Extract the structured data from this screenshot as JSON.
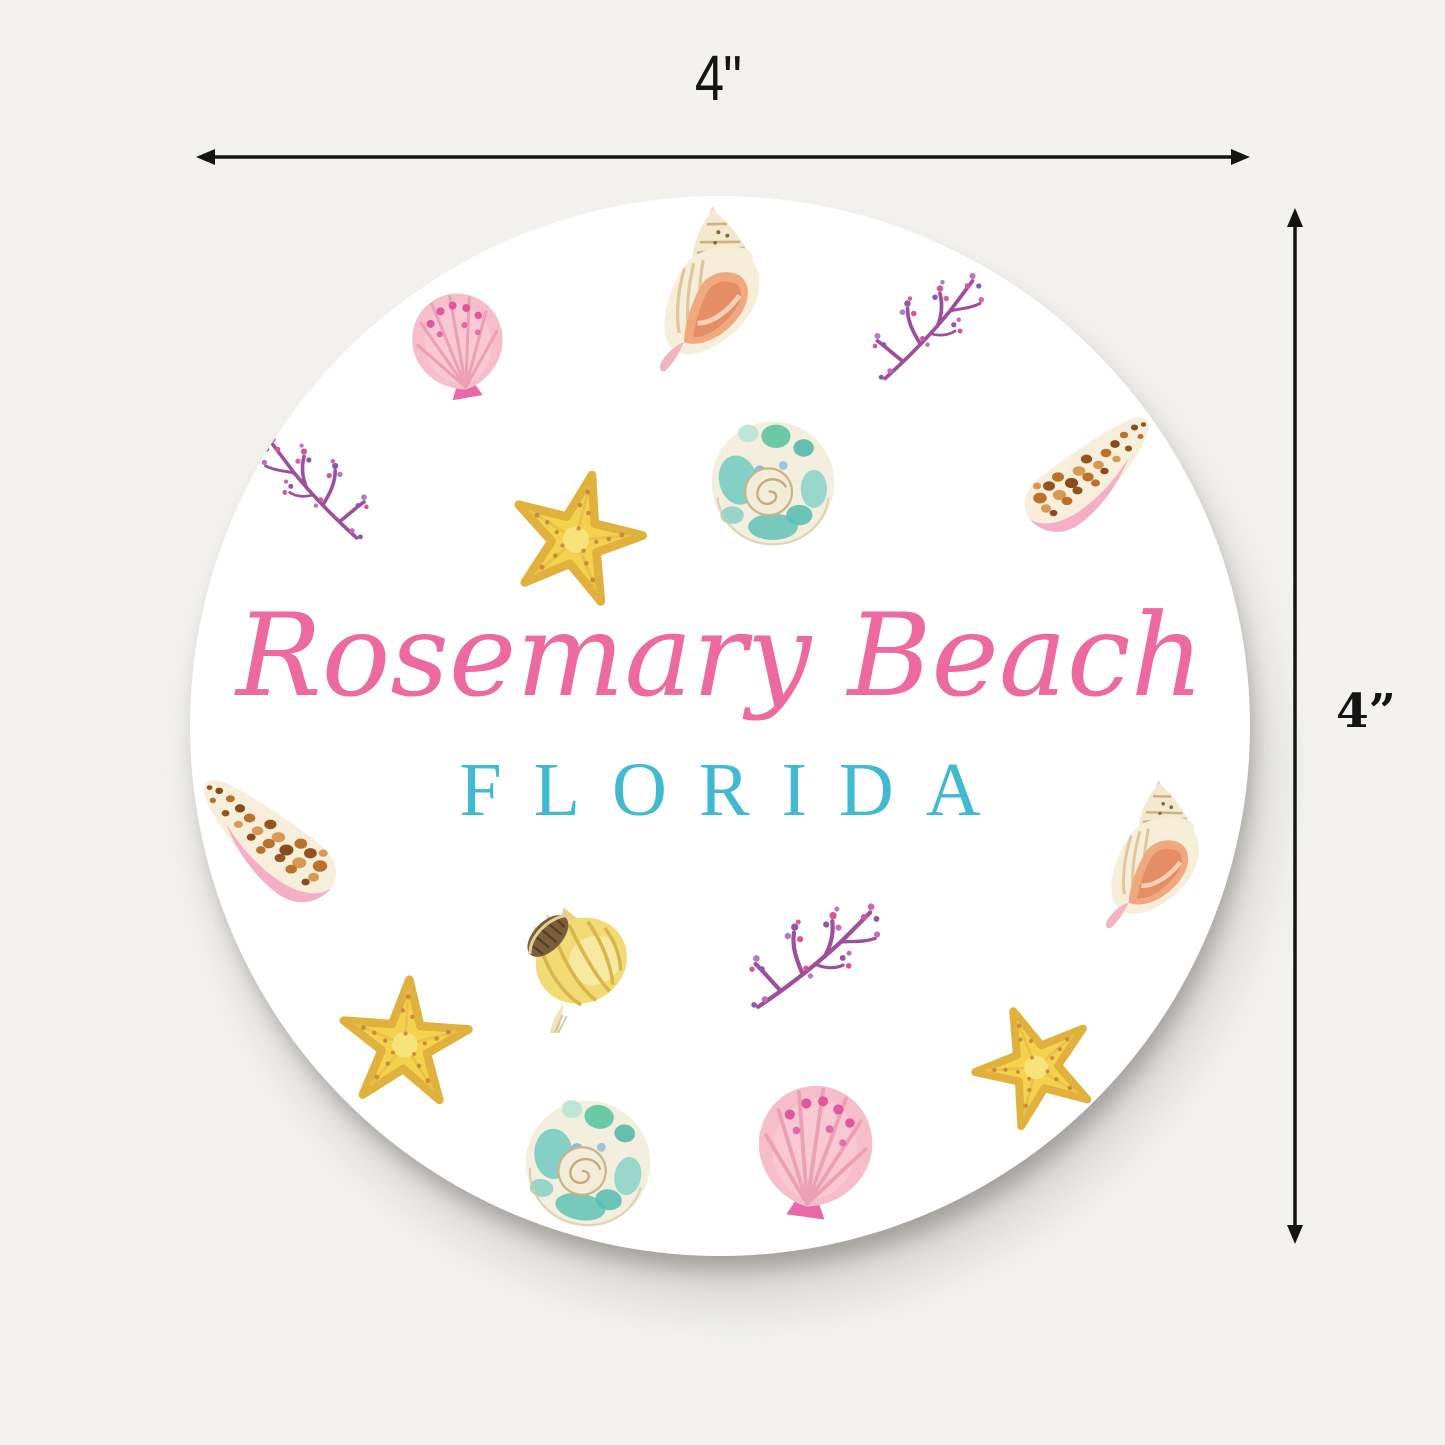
{
  "scene": {
    "type": "product-dimension-photo",
    "background_color": "#f3f2ef",
    "annotation_color": "#141414"
  },
  "dimension_annotations": {
    "width": {
      "label": "4\""
    },
    "height": {
      "label": "4”"
    }
  },
  "coaster": {
    "shape": "round",
    "surface_color": "#ffffff",
    "title": "Rosemary Beach",
    "subtitle": "FLORIDA",
    "colors": {
      "title": "#ec6aa0",
      "subtitle": "#41b9ce",
      "scallop_pink": "#f6bdca",
      "scallop_dots": "#e1569d",
      "conch_cream": "#f7eed9",
      "conch_opening": "#f0a87e",
      "coral_purple": "#9e4f9b",
      "coral_magenta": "#d9539b",
      "starfish_yellow": "#f4d24d",
      "turban_teal": "#79ccc3",
      "cone_brown_spots": "#b9712c",
      "cone_aperture_pink": "#f4aec6",
      "whelk_yellow": "#f2da74"
    },
    "motifs": [
      "scallop-shell",
      "conch-shell",
      "coral-branch",
      "coral-branch",
      "starfish",
      "turban-snail-shell",
      "leopard-cone-shell",
      "leopard-cone-shell",
      "conch-shell",
      "whelk-shell",
      "coral-branch",
      "starfish",
      "starfish",
      "turban-snail-shell",
      "scallop-shell"
    ]
  }
}
